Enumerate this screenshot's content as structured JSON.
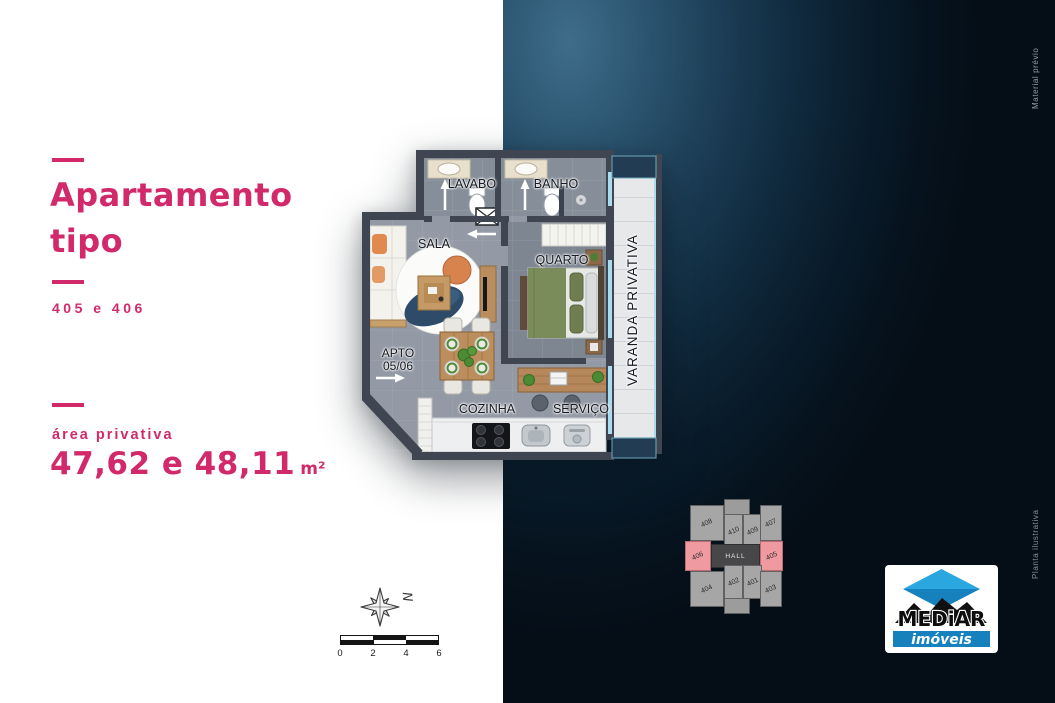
{
  "left_panel": {
    "title_line1": "Apartamento",
    "title_line2": "tipo",
    "subtitle": "405 e 406",
    "area_label": "área privativa",
    "area_value": "47,62 e 48,11",
    "area_unit": "m²"
  },
  "floor_plan": {
    "rooms": {
      "lavabo": "LAVABO",
      "banho": "BANHO",
      "sala": "SALA",
      "quarto": "QUARTO",
      "varanda": "VARANDA PRIVATIVA",
      "cozinha": "COZINHA",
      "servico": "SERVIÇO",
      "apto_line1": "APTO",
      "apto_line2": "05/06"
    }
  },
  "key_plan": {
    "hall_label": "HALL",
    "units": [
      {
        "label": "408",
        "highlighted": false
      },
      {
        "label": "410",
        "highlighted": false
      },
      {
        "label": "409",
        "highlighted": false
      },
      {
        "label": "407",
        "highlighted": false
      },
      {
        "label": "406",
        "highlighted": true
      },
      {
        "label": "405",
        "highlighted": true
      },
      {
        "label": "404",
        "highlighted": false
      },
      {
        "label": "402",
        "highlighted": false
      },
      {
        "label": "401",
        "highlighted": false
      },
      {
        "label": "403",
        "highlighted": false
      }
    ]
  },
  "compass": {
    "north_label": "N"
  },
  "scale_bar": {
    "ticks": [
      "0",
      "2",
      "4",
      "6"
    ]
  },
  "logo": {
    "brand": "MEDiAR",
    "tagline": "imóveis"
  },
  "watermarks": {
    "top_right": "Material prévio",
    "bottom_right": "Planta ilustrativa"
  },
  "colors": {
    "accent_pink": "#d2296b",
    "keyplan_highlight": "#ef9aa1",
    "logo_blue": "#1e9cd6",
    "background_dark": "#0a1a28",
    "wall_gray": "#3f4652"
  }
}
